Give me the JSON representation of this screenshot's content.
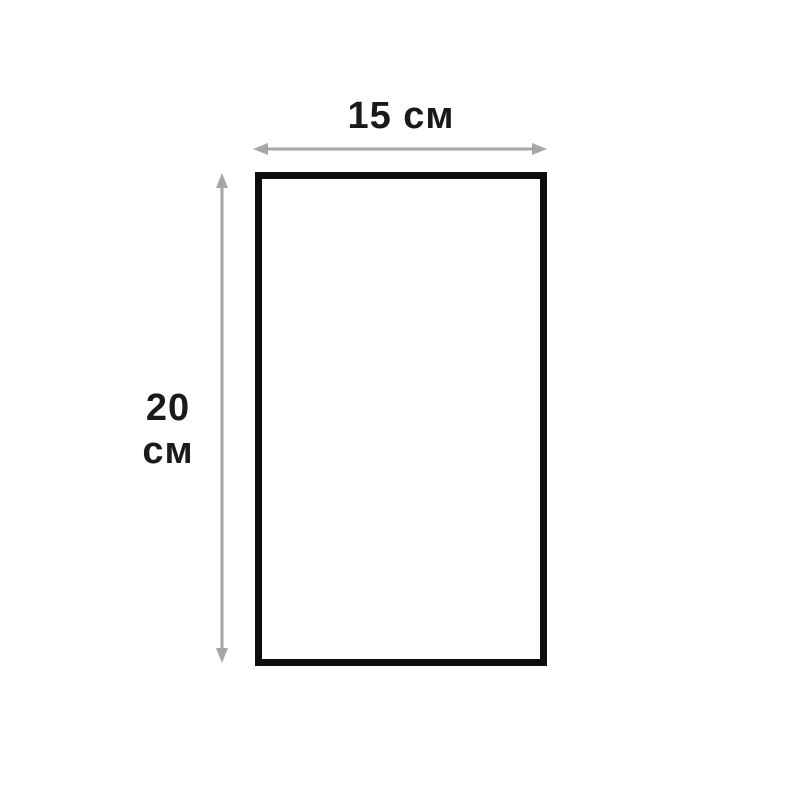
{
  "diagram": {
    "type": "dimension-diagram",
    "shape": "rectangle",
    "labels": {
      "width": "15 см",
      "height_line1": "20",
      "height_line2": "см"
    },
    "dimensions": {
      "width_value": 15,
      "height_value": 20,
      "unit": "см"
    },
    "colors": {
      "background": "#ffffff",
      "rectangle_border": "#0d0d0d",
      "arrow": "#a6a6a6",
      "text": "#1a1a1a"
    }
  }
}
